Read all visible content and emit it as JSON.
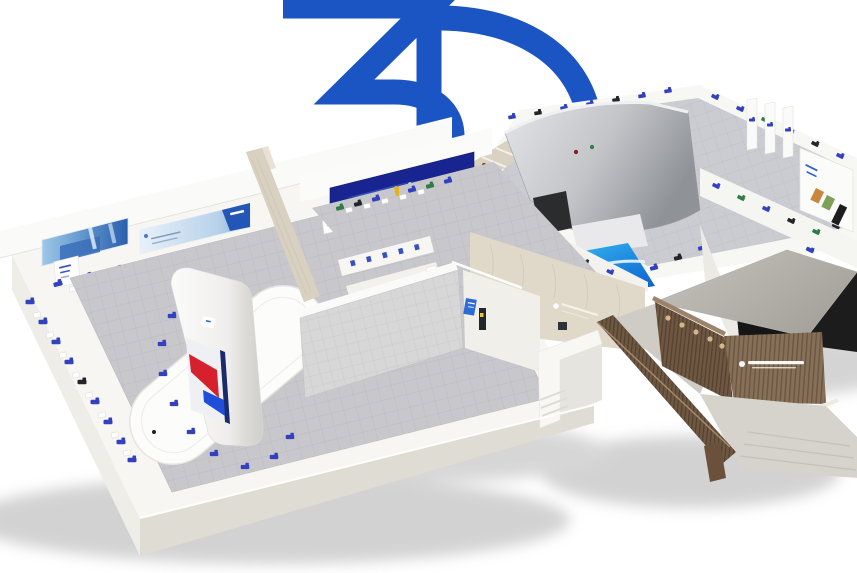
{
  "logo": {
    "text": "3D",
    "color": "#1b55c4"
  },
  "palette": {
    "background": "#ffffff",
    "floor_tile_gray": "#c6c6cb",
    "platform_white": "#f7f6f3",
    "travertine_beige": "#e0d8c8",
    "wood_brown": "#7d6551",
    "banner_dark_blue": "#18248f",
    "banner_light_blue": "#bdd4ec",
    "exhibit_item_blue": "#3340c0",
    "floor_graphic_blue": "#1a8de8",
    "tower_screen_red": "#d6202e",
    "tower_screen_blue": "#1f4fd8",
    "shadow_gray": "#969696"
  }
}
